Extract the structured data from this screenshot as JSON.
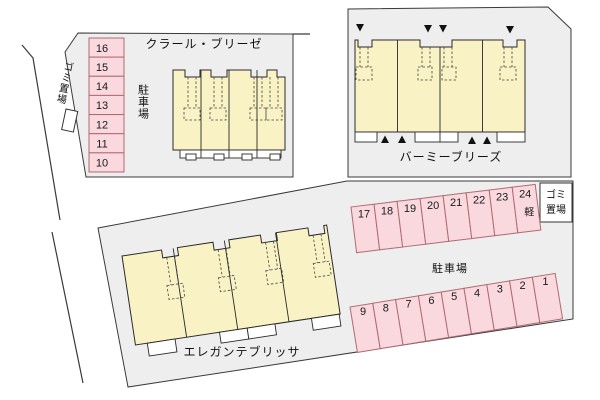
{
  "site_plan": {
    "buildings": {
      "top_left": {
        "name": "クラール・ブリーゼ"
      },
      "top_right": {
        "name": "バーミーブリーズ"
      },
      "bottom": {
        "name": "エレガンテブリッサ"
      }
    },
    "labels": {
      "parking_left": "駐車場",
      "parking_right": "駐車場",
      "garbage_left": "ゴミ置場",
      "garbage_box_line1": "ゴミ",
      "garbage_box_line2": "置場",
      "kei_car": "軽"
    },
    "parking_stalls": {
      "left_column": [
        "16",
        "15",
        "14",
        "13",
        "12",
        "11",
        "10"
      ],
      "upper_right_row": [
        "17",
        "18",
        "19",
        "20",
        "21",
        "22",
        "23",
        "24"
      ],
      "lower_right_row": [
        "9",
        "8",
        "7",
        "6",
        "5",
        "4",
        "3",
        "2",
        "1"
      ]
    },
    "colors": {
      "parcel_fill": "#eeeeee",
      "building_fill": "#f9f2c4",
      "stall_fill": "#f9d8de",
      "stall_border": "#b06a72",
      "outline": "#3a3a3a"
    }
  }
}
